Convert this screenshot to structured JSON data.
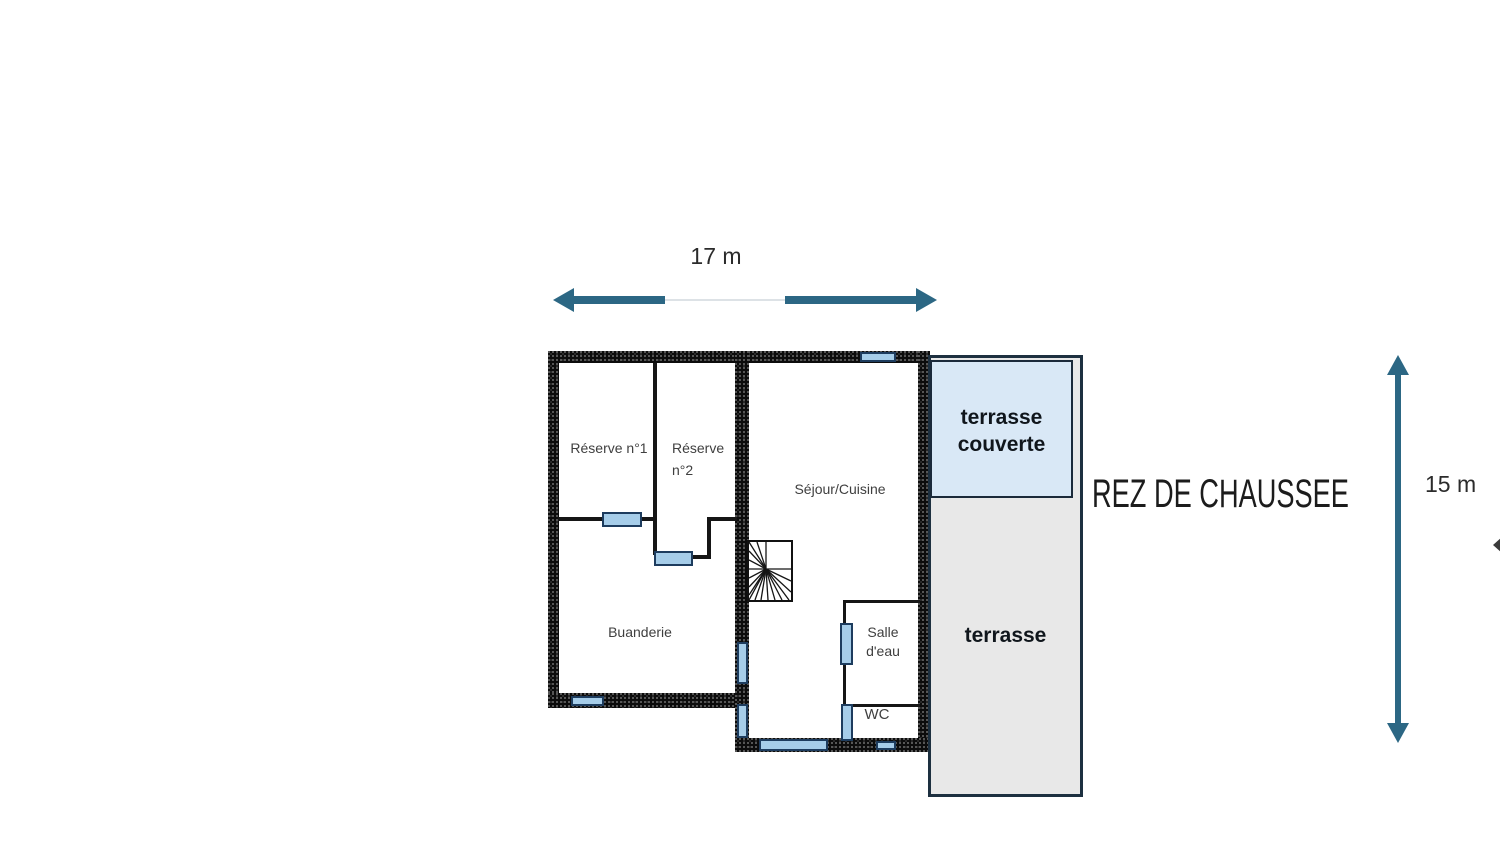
{
  "floor_title": "REZ DE CHAUSSEE",
  "dimensions": {
    "horizontal": "17 m",
    "vertical": "15 m"
  },
  "rooms": {
    "reserve1": "Réserve n°1",
    "reserve2": {
      "line1": "Réserve",
      "line2": "n°2"
    },
    "sejour": "Séjour/Cuisine",
    "buanderie": "Buanderie",
    "salle_deau": {
      "line1": "Salle",
      "line2": "d'eau"
    },
    "wc": "WC"
  },
  "outdoor": {
    "terrasse_couverte": {
      "line1": "terrasse",
      "line2": "couverte"
    },
    "terrasse": "terrasse"
  },
  "icons": {
    "stairs": "spiral-stairs-icon",
    "horizontal_dimension": "double-headed-arrow-horizontal",
    "vertical_dimension": "double-headed-arrow-vertical"
  },
  "colors": {
    "arrow": "#2c6784",
    "wall": "#0c0c0c",
    "window_fill": "#a6cde9",
    "window_border": "#1d3c5e",
    "terrasse_fill": "#e8e8e8",
    "terrasse_couverte_fill": "#d9e8f6",
    "terrasse_border": "#1d3040",
    "label_text": "#3f3f3f",
    "bold_text": "#10161c"
  }
}
